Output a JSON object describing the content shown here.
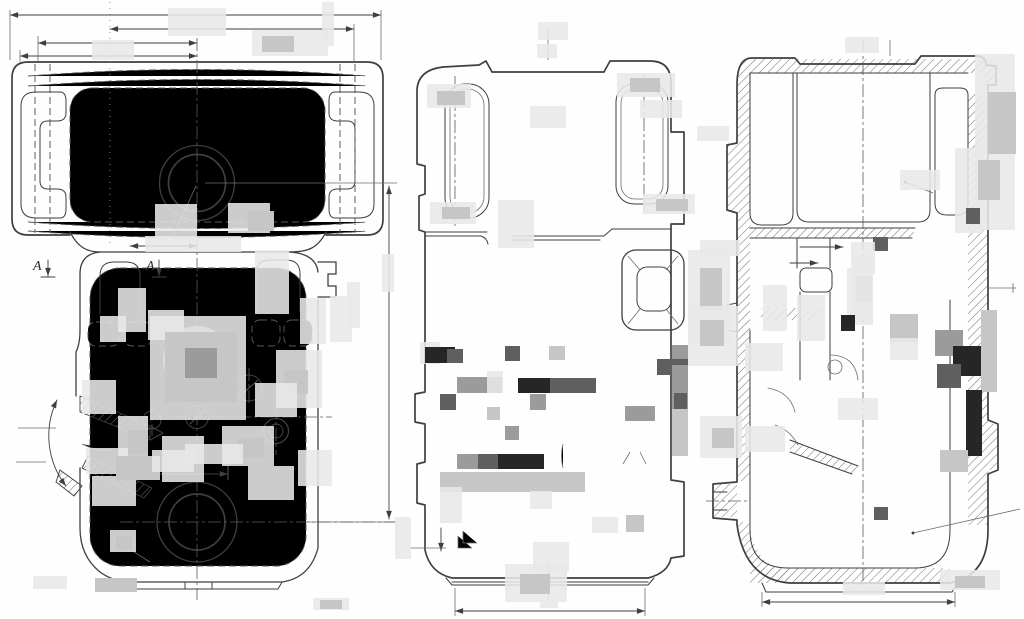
{
  "drawing": {
    "section_labels": [
      {
        "text": "А"
      },
      {
        "text": "А"
      }
    ],
    "colors": {
      "line": "#3f3f3f",
      "dash": "#585858",
      "paper": "#fefefe",
      "hatch": "#707070"
    },
    "redaction_palette": {
      "l": "#e8e8e8",
      "m": "#c6c6c6",
      "g": "#9b9b9b",
      "d": "#5f5f5f",
      "k": "#262626"
    },
    "redactions": [
      [
        168,
        8,
        58,
        28,
        "l"
      ],
      [
        92,
        40,
        42,
        20,
        "l"
      ],
      [
        252,
        30,
        76,
        26,
        "l"
      ],
      [
        262,
        36,
        32,
        16,
        "m"
      ],
      [
        322,
        2,
        12,
        44,
        "l"
      ],
      [
        155,
        204,
        42,
        38,
        "l"
      ],
      [
        228,
        203,
        42,
        30,
        "l"
      ],
      [
        248,
        211,
        26,
        20,
        "m"
      ],
      [
        145,
        236,
        96,
        16,
        "l"
      ],
      [
        538,
        22,
        30,
        18,
        "l"
      ],
      [
        537,
        44,
        20,
        14,
        "l"
      ],
      [
        530,
        106,
        36,
        22,
        "l"
      ],
      [
        498,
        200,
        36,
        48,
        "l"
      ],
      [
        427,
        84,
        44,
        24,
        "l"
      ],
      [
        437,
        91,
        28,
        14,
        "m"
      ],
      [
        430,
        202,
        46,
        22,
        "l"
      ],
      [
        442,
        207,
        28,
        12,
        "m"
      ],
      [
        617,
        73,
        58,
        24,
        "l"
      ],
      [
        630,
        78,
        30,
        14,
        "m"
      ],
      [
        640,
        100,
        42,
        18,
        "l"
      ],
      [
        697,
        126,
        32,
        15,
        "l"
      ],
      [
        643,
        194,
        52,
        20,
        "l"
      ],
      [
        656,
        199,
        32,
        12,
        "m"
      ],
      [
        700,
        240,
        40,
        16,
        "l"
      ],
      [
        118,
        288,
        28,
        44,
        "l"
      ],
      [
        100,
        316,
        26,
        26,
        "l"
      ],
      [
        148,
        310,
        36,
        30,
        "l"
      ],
      [
        255,
        250,
        34,
        64,
        "l"
      ],
      [
        300,
        298,
        26,
        46,
        "l"
      ],
      [
        330,
        296,
        22,
        46,
        "l"
      ],
      [
        382,
        254,
        12,
        38,
        "l"
      ],
      [
        347,
        282,
        13,
        46,
        "l"
      ],
      [
        150,
        316,
        96,
        104,
        "l"
      ],
      [
        165,
        332,
        72,
        70,
        "m"
      ],
      [
        185,
        348,
        32,
        30,
        "g"
      ],
      [
        276,
        350,
        46,
        58,
        "l"
      ],
      [
        284,
        370,
        24,
        24,
        "m"
      ],
      [
        82,
        380,
        34,
        34,
        "l"
      ],
      [
        118,
        416,
        30,
        52,
        "l"
      ],
      [
        128,
        430,
        20,
        24,
        "m"
      ],
      [
        162,
        436,
        42,
        46,
        "l"
      ],
      [
        222,
        426,
        52,
        40,
        "l"
      ],
      [
        238,
        438,
        26,
        20,
        "m"
      ],
      [
        255,
        383,
        42,
        34,
        "l"
      ],
      [
        92,
        476,
        44,
        30,
        "l"
      ],
      [
        248,
        466,
        46,
        34,
        "l"
      ],
      [
        298,
        450,
        34,
        36,
        "l"
      ],
      [
        86,
        448,
        42,
        26,
        "l"
      ],
      [
        116,
        456,
        44,
        24,
        "m"
      ],
      [
        152,
        450,
        42,
        22,
        "l"
      ],
      [
        185,
        444,
        58,
        20,
        "l"
      ],
      [
        110,
        530,
        26,
        22,
        "l"
      ],
      [
        116,
        536,
        16,
        14,
        "m"
      ],
      [
        33,
        576,
        34,
        13,
        "l"
      ],
      [
        95,
        578,
        42,
        14,
        "m"
      ],
      [
        313,
        598,
        36,
        12,
        "l"
      ],
      [
        320,
        600,
        22,
        9,
        "m"
      ],
      [
        420,
        342,
        20,
        22,
        "l"
      ],
      [
        425,
        347,
        30,
        16,
        "k"
      ],
      [
        447,
        349,
        16,
        14,
        "d"
      ],
      [
        505,
        346,
        15,
        15,
        "d"
      ],
      [
        549,
        346,
        16,
        14,
        "m"
      ],
      [
        457,
        377,
        45,
        16,
        "g"
      ],
      [
        487,
        371,
        16,
        22,
        "l"
      ],
      [
        518,
        378,
        32,
        15,
        "k"
      ],
      [
        550,
        378,
        46,
        15,
        "d"
      ],
      [
        530,
        394,
        16,
        16,
        "g"
      ],
      [
        440,
        394,
        16,
        16,
        "d"
      ],
      [
        487,
        407,
        13,
        13,
        "m"
      ],
      [
        505,
        426,
        14,
        14,
        "g"
      ],
      [
        457,
        454,
        45,
        15,
        "g"
      ],
      [
        478,
        454,
        20,
        15,
        "d"
      ],
      [
        498,
        454,
        46,
        15,
        "k"
      ],
      [
        440,
        472,
        145,
        20,
        "m"
      ],
      [
        440,
        487,
        22,
        36,
        "l"
      ],
      [
        530,
        491,
        22,
        18,
        "l"
      ],
      [
        592,
        517,
        26,
        16,
        "l"
      ],
      [
        626,
        515,
        18,
        17,
        "m"
      ],
      [
        533,
        542,
        36,
        30,
        "l"
      ],
      [
        505,
        564,
        62,
        38,
        "l"
      ],
      [
        520,
        574,
        30,
        20,
        "m"
      ],
      [
        540,
        600,
        18,
        8,
        "l"
      ],
      [
        395,
        517,
        16,
        42,
        "l"
      ],
      [
        672,
        345,
        16,
        22,
        "g"
      ],
      [
        657,
        359,
        31,
        16,
        "d"
      ],
      [
        672,
        365,
        16,
        45,
        "g"
      ],
      [
        674,
        393,
        13,
        27,
        "d"
      ],
      [
        672,
        409,
        16,
        47,
        "m"
      ],
      [
        688,
        250,
        42,
        94,
        "l"
      ],
      [
        700,
        268,
        22,
        42,
        "m"
      ],
      [
        625,
        406,
        30,
        15,
        "g"
      ],
      [
        845,
        37,
        34,
        16,
        "l"
      ],
      [
        975,
        54,
        40,
        176,
        "l"
      ],
      [
        988,
        92,
        28,
        62,
        "m"
      ],
      [
        955,
        148,
        28,
        85,
        "l"
      ],
      [
        978,
        160,
        22,
        40,
        "m"
      ],
      [
        900,
        170,
        40,
        20,
        "l"
      ],
      [
        966,
        208,
        14,
        16,
        "d"
      ],
      [
        873,
        237,
        15,
        14,
        "d"
      ],
      [
        851,
        242,
        24,
        32,
        "l"
      ],
      [
        853,
        258,
        20,
        62,
        "l"
      ],
      [
        856,
        276,
        16,
        26,
        "m"
      ],
      [
        847,
        268,
        26,
        57,
        "l"
      ],
      [
        688,
        306,
        50,
        60,
        "l"
      ],
      [
        700,
        320,
        24,
        26,
        "m"
      ],
      [
        745,
        343,
        38,
        28,
        "l"
      ],
      [
        763,
        285,
        24,
        46,
        "l"
      ],
      [
        797,
        295,
        28,
        46,
        "l"
      ],
      [
        841,
        315,
        14,
        16,
        "k"
      ],
      [
        890,
        314,
        28,
        28,
        "m"
      ],
      [
        890,
        338,
        28,
        22,
        "l"
      ],
      [
        935,
        330,
        28,
        26,
        "g"
      ],
      [
        953,
        346,
        28,
        30,
        "k"
      ],
      [
        937,
        364,
        24,
        24,
        "d"
      ],
      [
        981,
        310,
        16,
        82,
        "m"
      ],
      [
        966,
        390,
        16,
        66,
        "k"
      ],
      [
        940,
        450,
        28,
        22,
        "m"
      ],
      [
        700,
        416,
        42,
        42,
        "l"
      ],
      [
        712,
        428,
        22,
        20,
        "m"
      ],
      [
        745,
        426,
        40,
        26,
        "l"
      ],
      [
        838,
        398,
        40,
        22,
        "l"
      ],
      [
        874,
        507,
        14,
        13,
        "d"
      ],
      [
        940,
        570,
        60,
        20,
        "l"
      ],
      [
        955,
        576,
        30,
        12,
        "m"
      ],
      [
        843,
        582,
        42,
        13,
        "l"
      ]
    ]
  }
}
